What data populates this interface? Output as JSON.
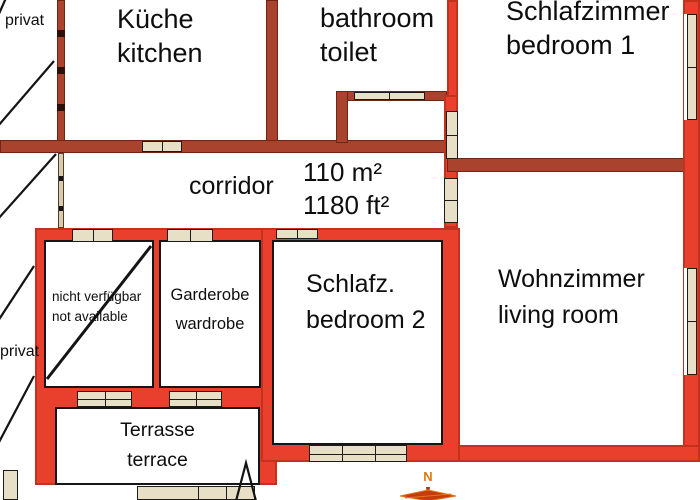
{
  "floorplan": {
    "area": {
      "metric": "110 m²",
      "imperial": "1180 ft²"
    },
    "rooms": {
      "kitchen": {
        "de": "Küche",
        "en": "kitchen"
      },
      "bathroom": {
        "line1": "bathroom",
        "line2": "toilet"
      },
      "bedroom1": {
        "de": "Schlafzimmer",
        "en": "bedroom 1"
      },
      "corridor": {
        "en": "corridor"
      },
      "bedroom2": {
        "de": "Schlafz.",
        "en": "bedroom 2"
      },
      "living_room": {
        "de": "Wohnzimmer",
        "en": "living room"
      },
      "wardrobe": {
        "de": "Garderobe",
        "en": "wardrobe"
      },
      "unavailable": {
        "de": "nicht verfügbar",
        "en": "not available"
      },
      "terrace": {
        "de": "Terrasse",
        "en": "terrace"
      }
    },
    "annotations": {
      "privat_top": "privat",
      "privat_left": "privat"
    },
    "compass": {
      "north_label": "N"
    },
    "colors": {
      "wall_bright": "#e8402c",
      "wall_dark": "#a9432e",
      "door_window_fill": "#e8e0c6",
      "compass_orange": "#dd7a10",
      "line_black": "#141414",
      "background": "#ffffff"
    }
  }
}
